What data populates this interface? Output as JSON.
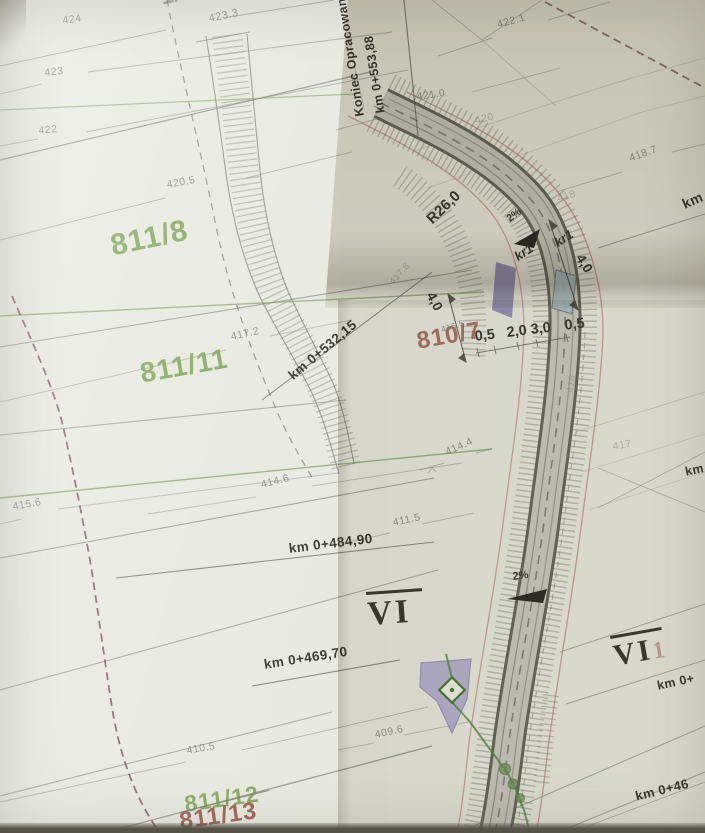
{
  "end_of_design": {
    "line1": "Koniec Opracowania",
    "line2": "km 0+553,88"
  },
  "parcels": [
    {
      "text": "811/8"
    },
    {
      "text": "811/11"
    },
    {
      "text": "810/7"
    },
    {
      "text": "811/12"
    },
    {
      "text": "811/13"
    },
    {
      "text": "1/54"
    }
  ],
  "chainages": [
    {
      "text": "km 0+532,15"
    },
    {
      "text": "km 0+484,90"
    },
    {
      "text": "km 0+469,70"
    },
    {
      "text": "km"
    },
    {
      "text": "km"
    },
    {
      "text": "km 0+"
    },
    {
      "text": "km 0+46"
    }
  ],
  "contours": [
    {
      "text": "424"
    },
    {
      "text": "423.3"
    },
    {
      "text": "423"
    },
    {
      "text": "422"
    },
    {
      "text": "420.5"
    },
    {
      "text": "422.1"
    },
    {
      "text": "421.0"
    },
    {
      "text": "418.7"
    },
    {
      "text": "417.2"
    },
    {
      "text": "415.6"
    },
    {
      "text": "414.6"
    },
    {
      "text": "414.4"
    },
    {
      "text": "411.5"
    },
    {
      "text": "410.5"
    },
    {
      "text": "409.6"
    },
    {
      "text": "416.5"
    },
    {
      "text": "417.8"
    },
    {
      "text": "420"
    },
    {
      "text": "418"
    },
    {
      "text": "418"
    },
    {
      "text": "417"
    }
  ],
  "annotations": {
    "radius": "R26,0",
    "kr1_a": "kr1",
    "kr1_b": "kr1",
    "slope_top": "2%",
    "slope_bottom": "2%",
    "dim_left": "4,0",
    "dim_right": "4,0",
    "width_1": "0,5",
    "width_2": "2,0",
    "width_3": "3,0",
    "width_4": "0,5",
    "section_center": "VI",
    "section_right": "VI",
    "section_right_suffix": "1"
  },
  "colors": {
    "paper": "#e8eae1",
    "road_surface": "#c8c9c1",
    "road_edge": "#686a5e",
    "contour_gray": "#878a80",
    "parcel_green": "#79a24f",
    "parcel_red": "#9c564b",
    "annotation_dark": "#3b3c33",
    "utility_green": "#5d8a43",
    "boundary_maroon": "#6e4752",
    "right_of_way_pink": "#b57a72",
    "structure_purple": "#8d8ab4",
    "structure_blue": "#a9bdc3",
    "structure_lavender": "#aba7cf"
  }
}
